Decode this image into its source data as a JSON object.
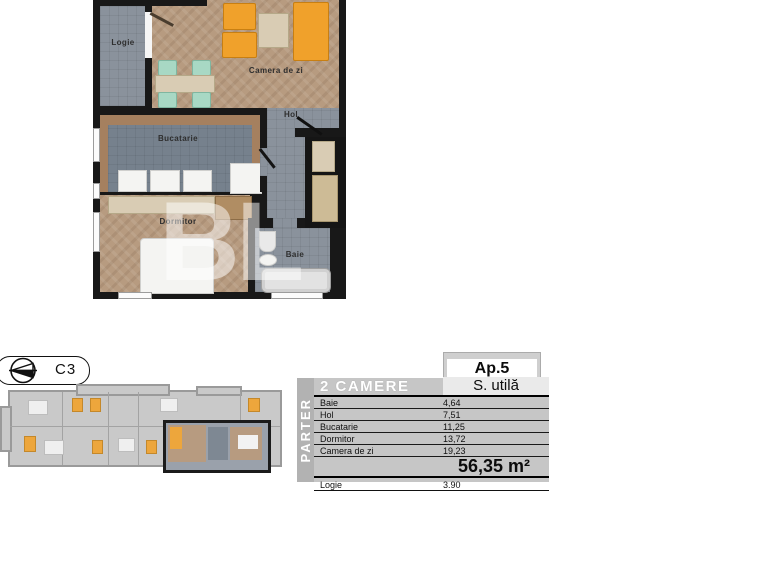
{
  "compass": {
    "label": "C3"
  },
  "floor_plan": {
    "watermark": "BL",
    "rooms": {
      "logie": "Logie",
      "camera_de_zi": "Camera de zi",
      "hol": "Hol",
      "bucatarie": "Bucatarie",
      "dormitor": "Dormitor",
      "baie": "Baie"
    }
  },
  "info_table": {
    "apartment": "Ap.5",
    "type": "2 CAMERE",
    "area_header": "S. utilă",
    "floor": "PARTER",
    "rows": [
      {
        "name": "Baie",
        "value": "4,64"
      },
      {
        "name": "Hol",
        "value": "7,51"
      },
      {
        "name": "Bucatarie",
        "value": "11,25"
      },
      {
        "name": "Dormitor",
        "value": "13,72"
      },
      {
        "name": "Camera de zi",
        "value": "19,23"
      }
    ],
    "total": "56,35 m²",
    "extra": {
      "name": "Logie",
      "value": "3.90"
    }
  },
  "colors": {
    "wall": "#181818",
    "wood_floor": "#b79b80",
    "gray_floor": "#8a929c",
    "orange_furniture": "#f0a12b",
    "teal_chair": "#a8d8c4",
    "beige_furniture": "#d9ccb4",
    "table_panel": "#c6c6c6",
    "table_strip": "#b2b2b2"
  }
}
